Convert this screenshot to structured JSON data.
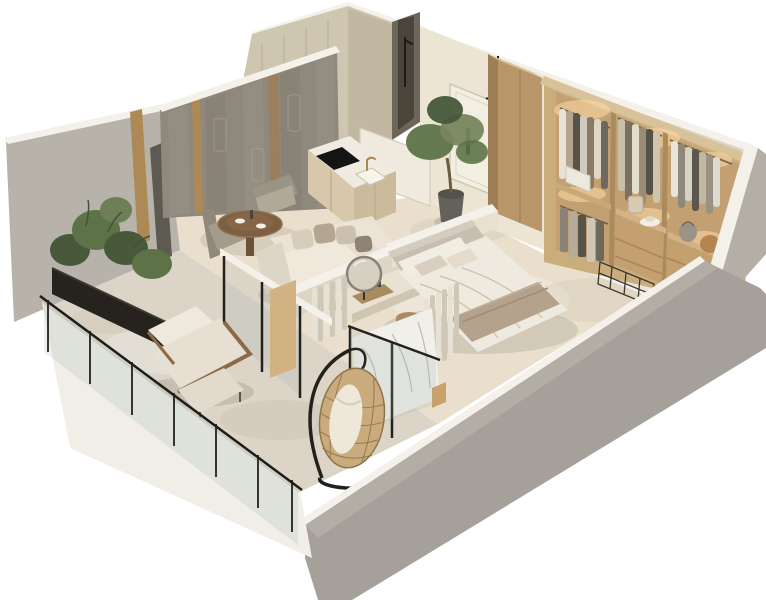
{
  "scene": {
    "type": "isometric-3d-floor-plan-cutaway-render",
    "description": "Photorealistic 3D cutaway floor plan of a one-bedroom apartment with balcony, living-dining room, kitchen, bathroom, entry hall, bedroom and walk-in wardrobe. Neutral beige and taupe palette on white background. No visible text.",
    "background": "#ffffff"
  },
  "palette": {
    "background": "#ffffff",
    "exteriorCut": "#f3f1ea",
    "frontWall": "#a5a19a",
    "frontWallTop": "#b2aea5",
    "rightWall": "#b3afa5",
    "leftWall": "#b7b3aa",
    "backWallBeige": "#ddd5c3",
    "interiorWall": "#ece5d4",
    "featureWall": "#8f887d",
    "goldAccent": "#ad8a55",
    "travertine": "#cfc6b2",
    "travertineDark": "#c2b7a0",
    "showerRecess": "#6e665a",
    "floorInterior": "#e9dfcc",
    "floorBalcony": "#dcd5c7",
    "wood": "#c9ad7d",
    "woodDark": "#a9875c",
    "woodLight": "#d8c29a",
    "wardrobeBack": "#c2a071",
    "ledGlow": "#ffdba6",
    "kitchenCabinet": "#d8c8ab",
    "counterTop": "#f0ebe0",
    "cooktop": "#141414",
    "sofa": "#e5ddcf",
    "cushionTaupe": "#b4a591",
    "bedDuvet": "#efeadf",
    "bedThrow": "#b5a28c",
    "headboard": "#c7bdb0",
    "curtain": "#e8e2d5",
    "plant": "#5d7347",
    "plantDark": "#47593a",
    "planter": "#26231e",
    "rattan": "#c9ab7e",
    "frameBlack": "#23211d",
    "glassTint": "rgba(150,170,165,0.18)",
    "marble": "#f1efe9",
    "mirror": "#d6d0c2"
  },
  "rooms": [
    {
      "id": "balcony",
      "furniture": [
        "glass-railing",
        "planter-box",
        "plants",
        "lounge-armchair",
        "ottoman",
        "side-stool",
        "hanging-egg-chair"
      ]
    },
    {
      "id": "living-room",
      "furniture": [
        "textured-feature-wall",
        "gold-wall-strips",
        "sofa",
        "throw-pillows",
        "round-dining-table",
        "dining-chairs",
        "sliding-glass-doors",
        "curtains"
      ]
    },
    {
      "id": "kitchen",
      "furniture": [
        "kitchen-counter",
        "cooktop",
        "sink",
        "brass-faucet",
        "cabinets",
        "interior-door"
      ]
    },
    {
      "id": "bathroom",
      "furniture": [
        "travertine-walls",
        "walk-in-shower",
        "shower-fixture"
      ]
    },
    {
      "id": "entry-hall",
      "furniture": [
        "entry-door",
        "coat-rack",
        "hanging-coat",
        "olive-tree",
        "tall-cabinet"
      ]
    },
    {
      "id": "bedroom",
      "furniture": [
        "double-bed",
        "upholstered-headboard",
        "pillows",
        "throw-blanket",
        "round-nightstand",
        "vanity-desk",
        "round-mirror",
        "curtains",
        "marble-window-wall"
      ]
    },
    {
      "id": "walk-in-wardrobe",
      "furniture": [
        "open-wardrobe",
        "hanging-clothes",
        "shelf-with-box",
        "drawer-units",
        "baskets",
        "hat",
        "wire-basket",
        "led-strip-lighting"
      ]
    }
  ],
  "structure": [
    "cutaway-exterior-walls",
    "white-cut-wall-tops",
    "glass-balcony-railing",
    "stone-flooring"
  ]
}
